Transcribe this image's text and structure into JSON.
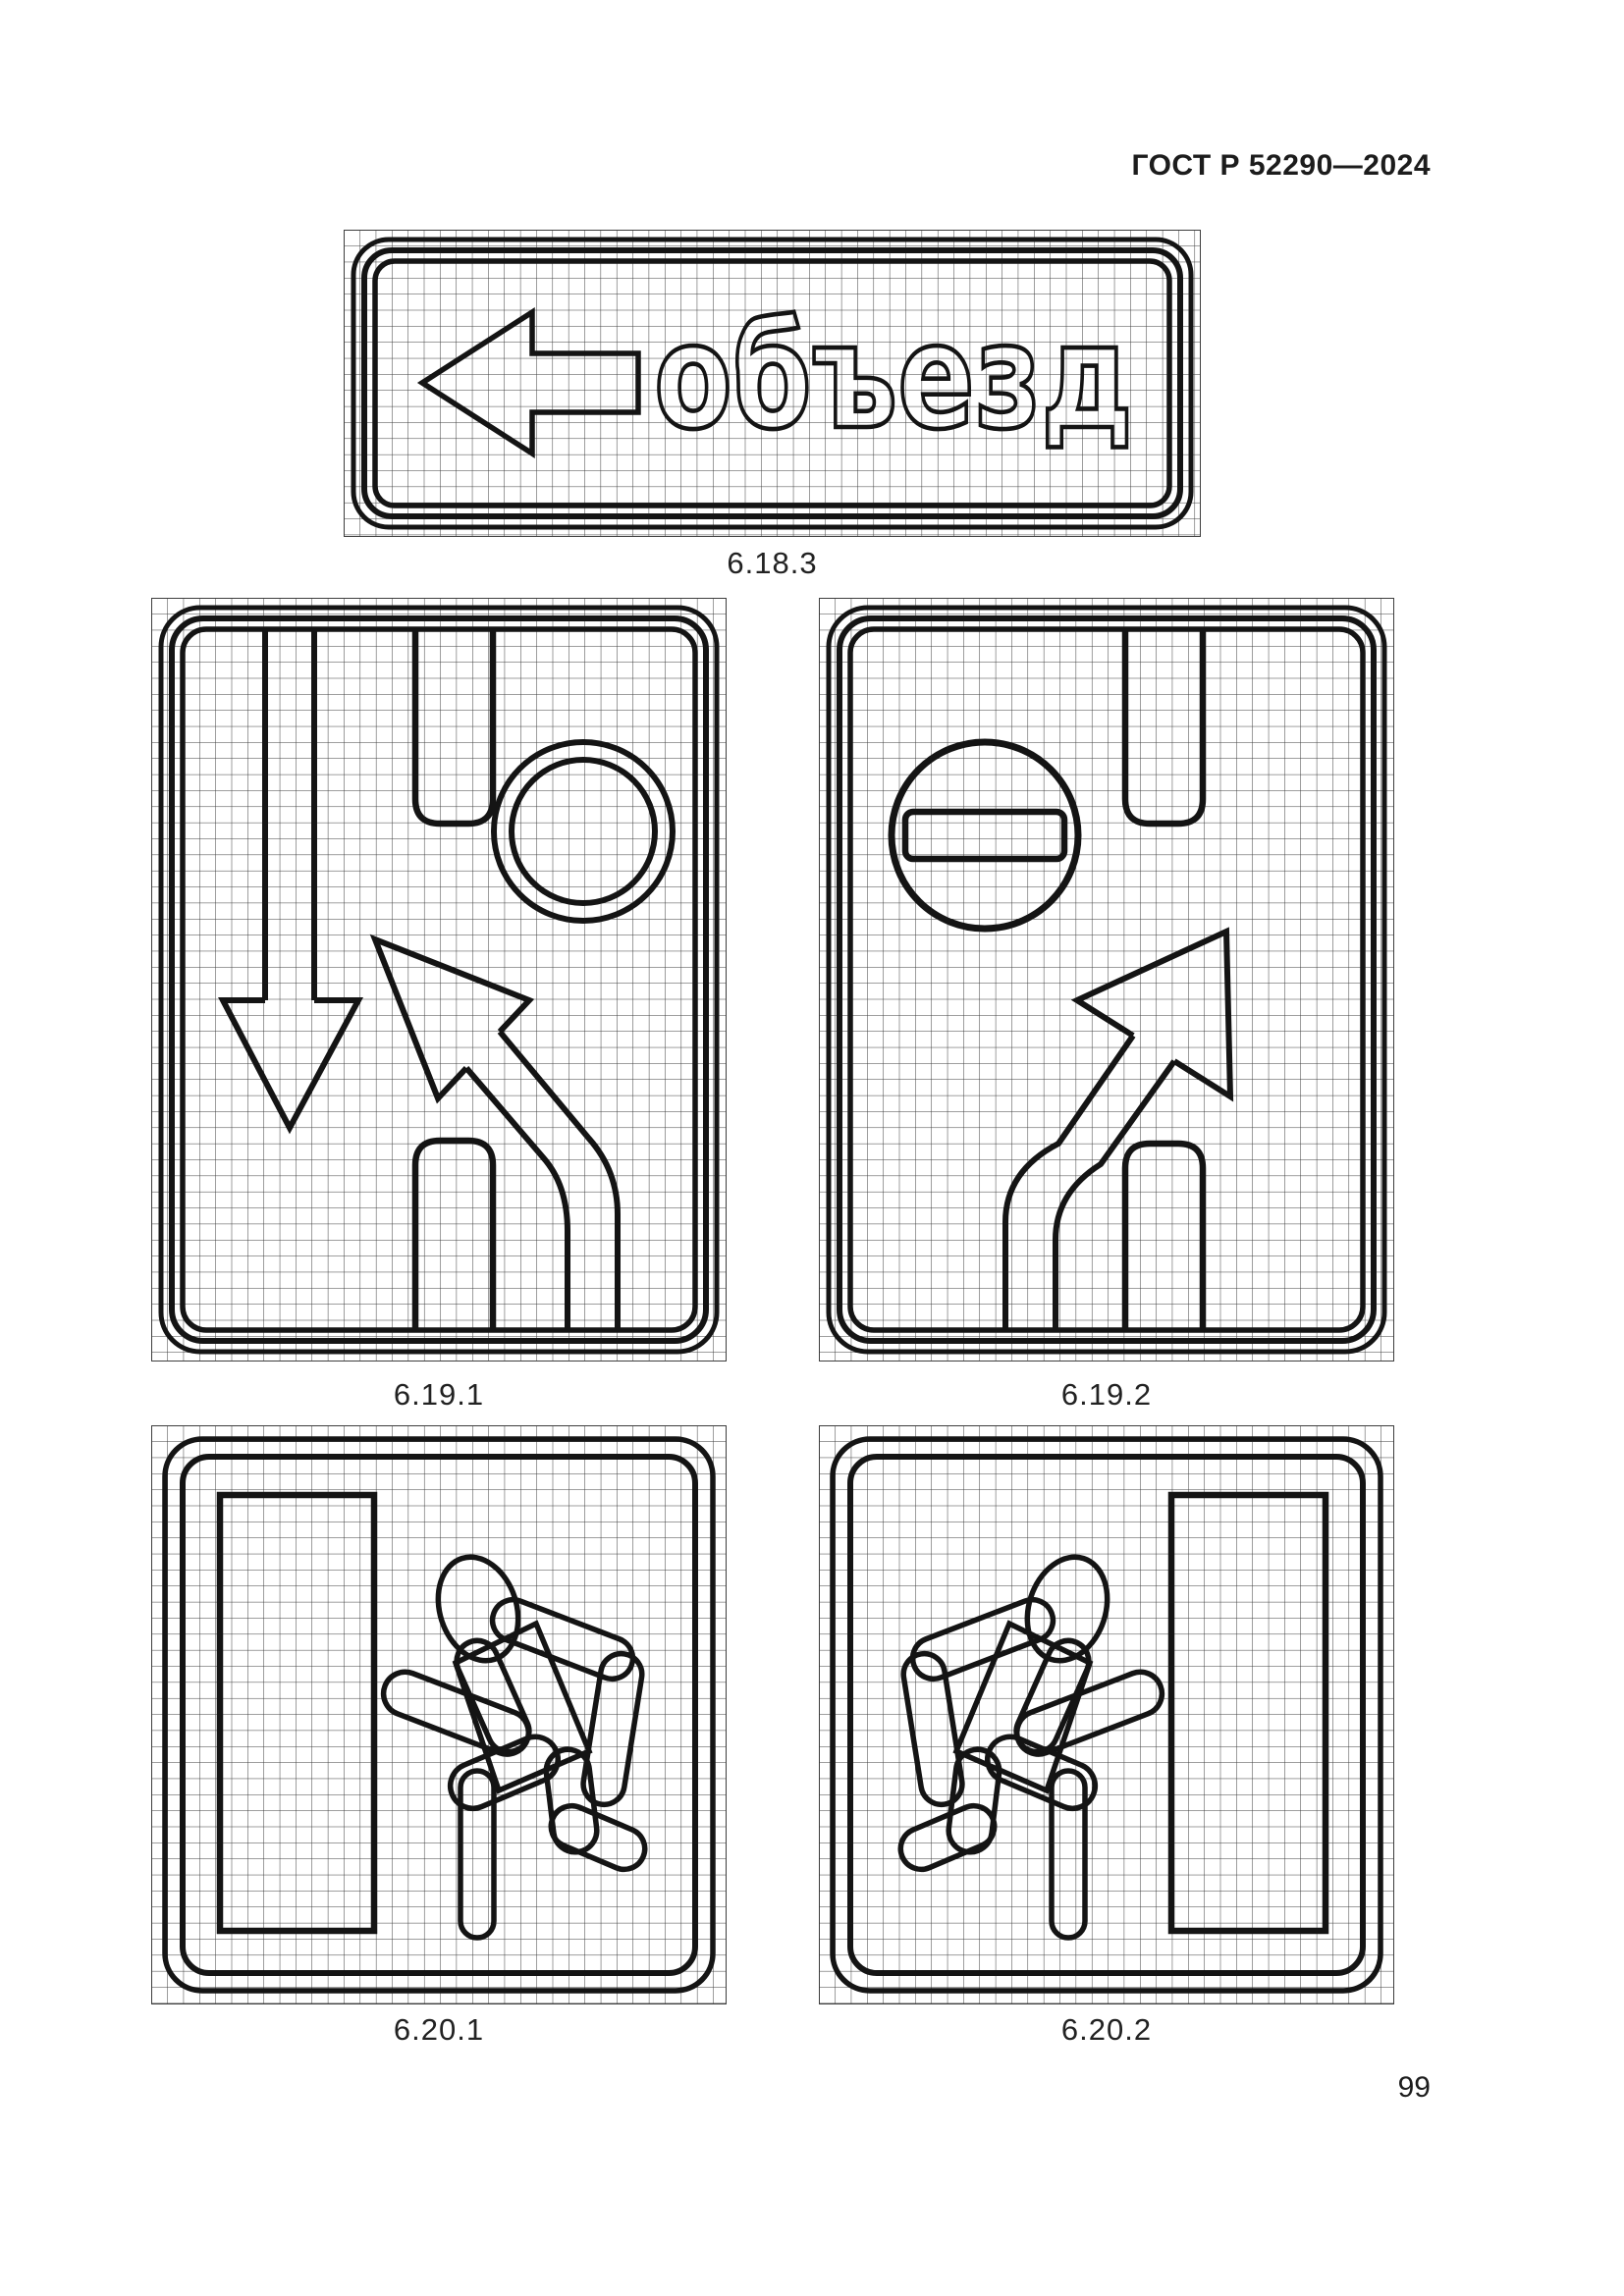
{
  "header": {
    "standard_code": "ГОСТ Р 52290—2024"
  },
  "figures": {
    "f6183": {
      "caption": "6.18.3",
      "sign_text": "объезд",
      "pictograms": [
        "left-arrow-icon"
      ]
    },
    "f6191": {
      "caption": "6.19.1",
      "pictograms": [
        "down-arrow-icon",
        "prohibition-ring-icon",
        "bent-arrow-up-left-icon",
        "lane-divider"
      ]
    },
    "f6192": {
      "caption": "6.19.2",
      "pictograms": [
        "no-entry-circle-icon",
        "bent-arrow-up-right-icon",
        "lane-divider"
      ]
    },
    "f6201": {
      "caption": "6.20.1",
      "pictograms": [
        "door-icon",
        "running-person-icon"
      ]
    },
    "f6202": {
      "caption": "6.20.2",
      "pictograms": [
        "running-person-icon",
        "door-icon"
      ]
    }
  },
  "footer": {
    "page_number": "99"
  },
  "colors": {
    "ink": "#141414",
    "grid_line": "#3d3d3d",
    "paper": "#ffffff"
  }
}
